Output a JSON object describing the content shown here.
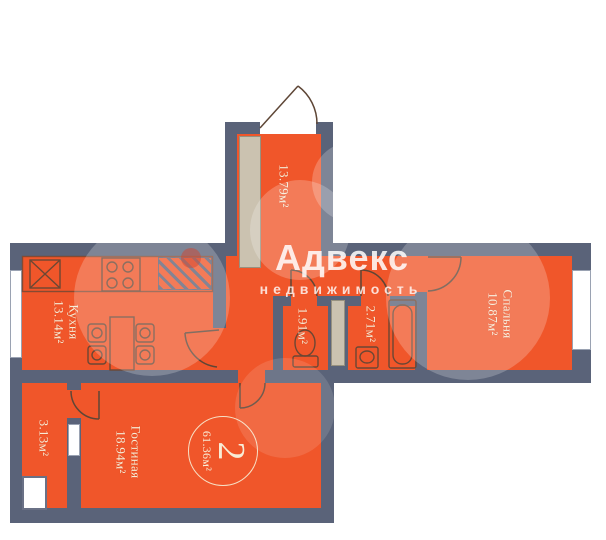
{
  "plan": {
    "type": "apartment-floor-plan",
    "badge": {
      "rooms_count": "2",
      "total_area": "61.36м²"
    },
    "rooms": [
      {
        "id": "hallway",
        "area": "13.79м²"
      },
      {
        "id": "kitchen",
        "name": "Кухня",
        "area": "13.14м²"
      },
      {
        "id": "wc",
        "area": "1.91м²"
      },
      {
        "id": "bathroom",
        "area": "2.71м²"
      },
      {
        "id": "bedroom",
        "name": "Спальня",
        "area": "10.87м²"
      },
      {
        "id": "living-room",
        "name": "Гостиная",
        "area": "18.94м²"
      },
      {
        "id": "storage",
        "area": "3.13м²"
      }
    ]
  },
  "watermark": {
    "brand": "Адвекс",
    "sub": "недвижимость"
  },
  "colors": {
    "room_fill": "#f0562a",
    "walls": "#5a6379",
    "labels": "#f8ecd6",
    "wardrobe": "#cbc2b0",
    "window": "#ffffff"
  }
}
